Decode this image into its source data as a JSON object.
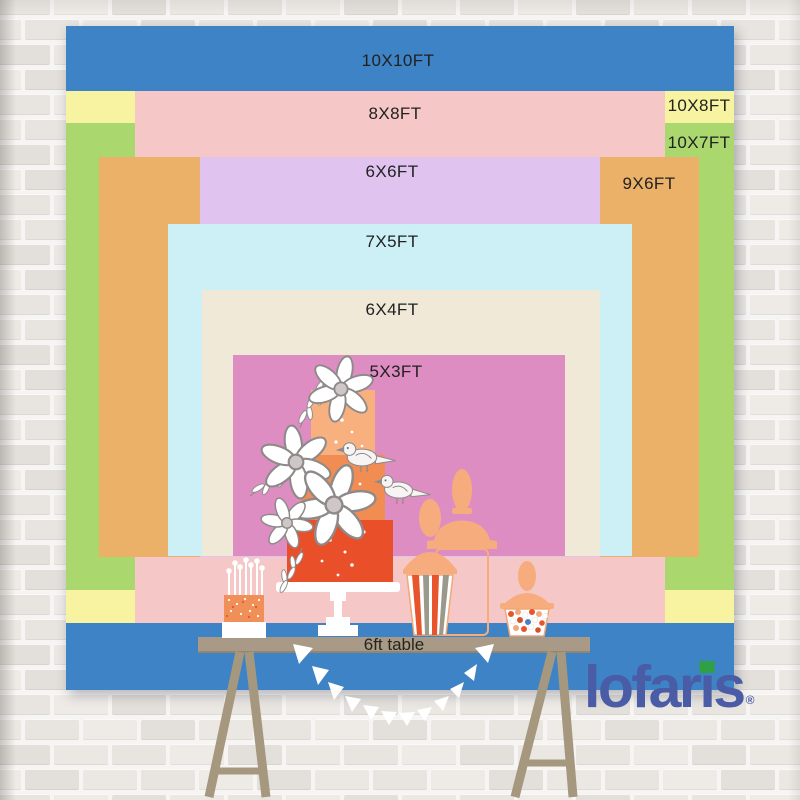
{
  "backdrop_chart": {
    "type": "nested-size-diagram",
    "unit": "FT",
    "sizes": [
      {
        "label": "10X10FT",
        "width_ft": 10,
        "height_ft": 10,
        "color": "#3e83c5"
      },
      {
        "label": "10X8FT",
        "width_ft": 10,
        "height_ft": 8,
        "color": "#f8f3a1"
      },
      {
        "label": "10X7FT",
        "width_ft": 10,
        "height_ft": 7,
        "color": "#aad86f"
      },
      {
        "label": "8X8FT",
        "width_ft": 8,
        "height_ft": 8,
        "color": "#f5c8c7"
      },
      {
        "label": "9X6FT",
        "width_ft": 9,
        "height_ft": 6,
        "color": "#ecb168"
      },
      {
        "label": "6X6FT",
        "width_ft": 6,
        "height_ft": 6,
        "color": "#e1c3f0"
      },
      {
        "label": "7X5FT",
        "width_ft": 7,
        "height_ft": 5,
        "color": "#cdf0f6"
      },
      {
        "label": "6X4FT",
        "width_ft": 6,
        "height_ft": 4,
        "color": "#f0e9d8"
      },
      {
        "label": "5X3FT",
        "width_ft": 5,
        "height_ft": 3,
        "color": "#de8dc2"
      }
    ]
  },
  "table": {
    "label": "6ft table"
  },
  "brand": {
    "logo_text": "lofaris",
    "registered_mark": "®",
    "logo_color": "#4a5ca6",
    "logo_accent_color": "#2fa043"
  },
  "colors": {
    "peach": "#f6ac7c",
    "peach_outline": "#f0a878",
    "cake_top": "#f8b17e",
    "cake_mid": "#f18c52",
    "cake_bottom": "#e94f28",
    "stripe_orange": "#e8542c",
    "stripe_gray": "#9b998c",
    "candy_blue": "#4a7fc4",
    "wood": "#a89a86",
    "wood_dark": "#93866f",
    "leg_wood": "#a6987f",
    "outline_gray": "#8e8a8a",
    "white": "#ffffff"
  }
}
